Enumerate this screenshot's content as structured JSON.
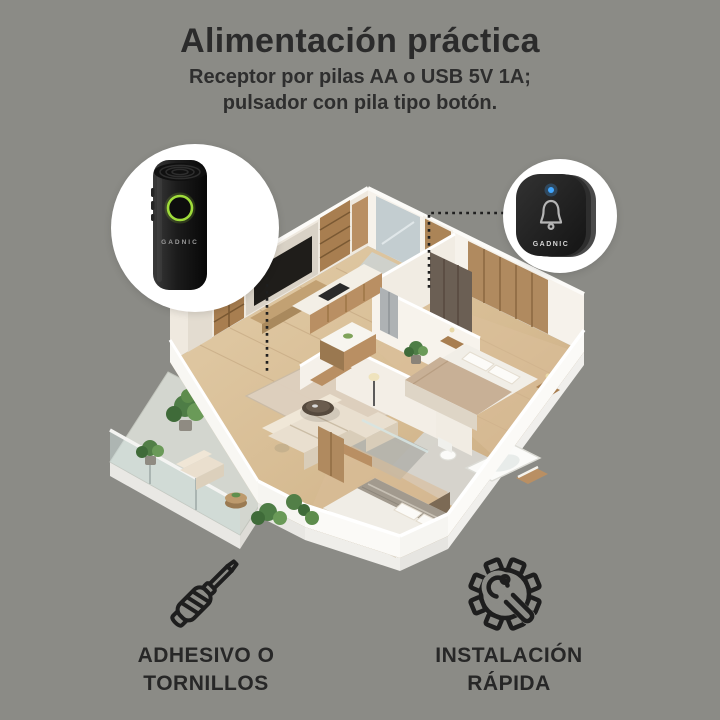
{
  "header": {
    "title": "Alimentación práctica",
    "subtitle_line1": "Receptor por pilas AA o USB 5V 1A;",
    "subtitle_line2": "pulsador con pila tipo botón."
  },
  "devices": {
    "receiver": {
      "brand": "GADNIC",
      "led_color": "#9fdc3a"
    },
    "button": {
      "brand": "GADNIC",
      "led_color": "#42a7ff"
    }
  },
  "features": [
    {
      "icon": "screwdriver-icon",
      "line1": "ADHESIVO O",
      "line2": "TORNILLOS"
    },
    {
      "icon": "gear-wrench-icon",
      "line1": "INSTALACIÓN",
      "line2": "RÁPIDA"
    }
  ],
  "colors": {
    "background": "#8b8b86",
    "text": "#2b2b2b",
    "callout_circle": "#ffffff",
    "callout_line": "#1f1f1f"
  }
}
